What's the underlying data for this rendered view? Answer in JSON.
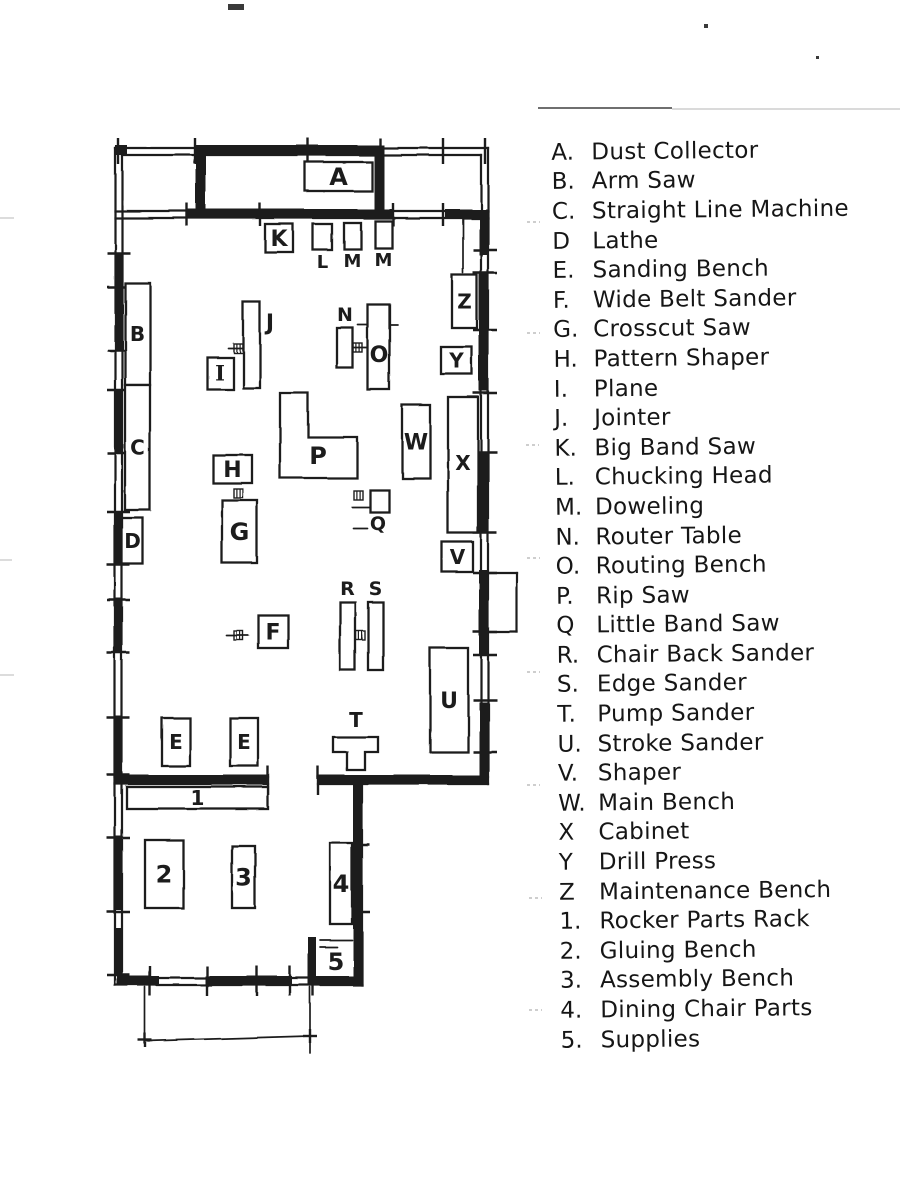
{
  "document_title": "Woodshop floor plan sketch with machine legend",
  "ink_color": "#1c1c1c",
  "paper_color": "#ffffff",
  "legend": {
    "items": [
      {
        "key": "A.",
        "label": "Dust Collector"
      },
      {
        "key": "B.",
        "label": "Arm Saw"
      },
      {
        "key": "C.",
        "label": "Straight Line Machine"
      },
      {
        "key": "D",
        "label": "Lathe"
      },
      {
        "key": "E.",
        "label": "Sanding Bench"
      },
      {
        "key": "F.",
        "label": "Wide Belt Sander"
      },
      {
        "key": "G.",
        "label": "Crosscut Saw"
      },
      {
        "key": "H.",
        "label": "Pattern Shaper"
      },
      {
        "key": "I.",
        "label": "Plane"
      },
      {
        "key": "J.",
        "label": "Jointer"
      },
      {
        "key": "K.",
        "label": "Big Band Saw"
      },
      {
        "key": "L.",
        "label": "Chucking Head"
      },
      {
        "key": "M.",
        "label": "Doweling"
      },
      {
        "key": "N.",
        "label": "Router Table"
      },
      {
        "key": "O.",
        "label": "Routing Bench"
      },
      {
        "key": "P.",
        "label": "Rip Saw"
      },
      {
        "key": "Q",
        "label": "Little Band Saw"
      },
      {
        "key": "R.",
        "label": "Chair Back Sander"
      },
      {
        "key": "S.",
        "label": "Edge Sander"
      },
      {
        "key": "T.",
        "label": "Pump Sander"
      },
      {
        "key": "U.",
        "label": "Stroke Sander"
      },
      {
        "key": "V.",
        "label": "Shaper"
      },
      {
        "key": "W.",
        "label": "Main Bench"
      },
      {
        "key": "X",
        "label": "Cabinet"
      },
      {
        "key": "Y",
        "label": "Drill Press"
      },
      {
        "key": "Z",
        "label": "Maintenance Bench"
      },
      {
        "key": "1.",
        "label": "Rocker Parts Rack"
      },
      {
        "key": "2.",
        "label": "Gluing Bench"
      },
      {
        "key": "3.",
        "label": "Assembly Bench"
      },
      {
        "key": "4.",
        "label": "Dining Chair Parts"
      },
      {
        "key": "5.",
        "label": "Supplies"
      }
    ]
  },
  "floorplan": {
    "machines": [
      {
        "id": "A",
        "label": "A",
        "x": 305,
        "y": 162,
        "w": 67,
        "h": 29,
        "pos": "inside",
        "size": 24
      },
      {
        "id": "K",
        "label": "K",
        "x": 265,
        "y": 224,
        "w": 28,
        "h": 28,
        "pos": "inside",
        "size": 22
      },
      {
        "id": "L",
        "label": "L",
        "x": 313,
        "y": 224,
        "w": 19,
        "h": 26,
        "pos": "below",
        "size": 18
      },
      {
        "id": "M1",
        "label": "M",
        "x": 344,
        "y": 223,
        "w": 17,
        "h": 26,
        "pos": "below",
        "size": 18
      },
      {
        "id": "M2",
        "label": "M",
        "x": 375,
        "y": 221,
        "w": 17,
        "h": 27,
        "pos": "below",
        "size": 18
      },
      {
        "id": "B",
        "label": "B",
        "x": 125,
        "y": 283,
        "w": 25,
        "h": 102,
        "pos": "inside",
        "size": 20
      },
      {
        "id": "C",
        "label": "C",
        "x": 125,
        "y": 385,
        "w": 25,
        "h": 125,
        "pos": "inside",
        "size": 20
      },
      {
        "id": "D",
        "label": "D",
        "x": 122,
        "y": 518,
        "w": 21,
        "h": 46,
        "pos": "inside",
        "size": 20
      },
      {
        "id": "I",
        "label": "I",
        "x": 207,
        "y": 357,
        "w": 26,
        "h": 32,
        "pos": "inside",
        "size": 21,
        "serif": true
      },
      {
        "id": "J",
        "label": "J",
        "x": 243,
        "y": 302,
        "w": 17,
        "h": 86,
        "pos": "right",
        "size": 22,
        "lx": 270,
        "ly": 330
      },
      {
        "id": "N",
        "label": "N",
        "x": 337,
        "y": 328,
        "w": 16,
        "h": 40,
        "pos": "above",
        "size": 19
      },
      {
        "id": "O",
        "label": "O",
        "x": 368,
        "y": 305,
        "w": 22,
        "h": 85,
        "pos": "inside",
        "size": 22,
        "ly": 362
      },
      {
        "id": "Z",
        "label": "Z",
        "x": 452,
        "y": 275,
        "w": 25,
        "h": 53,
        "pos": "inside",
        "size": 20
      },
      {
        "id": "Y",
        "label": "Y",
        "x": 441,
        "y": 347,
        "w": 31,
        "h": 27,
        "pos": "inside",
        "size": 20
      },
      {
        "id": "H",
        "label": "H",
        "x": 213,
        "y": 455,
        "w": 39,
        "h": 28,
        "pos": "inside",
        "size": 22
      },
      {
        "id": "G",
        "label": "G",
        "x": 222,
        "y": 500,
        "w": 35,
        "h": 63,
        "pos": "inside",
        "size": 24
      },
      {
        "id": "W",
        "label": "W",
        "x": 402,
        "y": 405,
        "w": 28,
        "h": 73,
        "pos": "inside",
        "size": 22
      },
      {
        "id": "X",
        "label": "X",
        "x": 448,
        "y": 397,
        "w": 30,
        "h": 136,
        "pos": "inside",
        "size": 20,
        "ly": 470
      },
      {
        "id": "Q",
        "label": "Q",
        "x": 370,
        "y": 490,
        "w": 19,
        "h": 22,
        "pos": "below",
        "size": 19,
        "lx": 378,
        "ly": 530
      },
      {
        "id": "V",
        "label": "V",
        "x": 442,
        "y": 542,
        "w": 31,
        "h": 30,
        "pos": "inside",
        "size": 20
      },
      {
        "id": "F",
        "label": "F",
        "x": 258,
        "y": 615,
        "w": 30,
        "h": 33,
        "pos": "inside",
        "size": 22
      },
      {
        "id": "R",
        "label": "R",
        "x": 340,
        "y": 602,
        "w": 15,
        "h": 68,
        "pos": "above",
        "size": 19
      },
      {
        "id": "S",
        "label": "S",
        "x": 368,
        "y": 602,
        "w": 15,
        "h": 68,
        "pos": "above",
        "size": 19
      },
      {
        "id": "U",
        "label": "U",
        "x": 430,
        "y": 648,
        "w": 38,
        "h": 104,
        "pos": "inside",
        "size": 22
      },
      {
        "id": "E1",
        "label": "E",
        "x": 162,
        "y": 718,
        "w": 28,
        "h": 48,
        "pos": "inside",
        "size": 20
      },
      {
        "id": "E2",
        "label": "E",
        "x": 230,
        "y": 718,
        "w": 28,
        "h": 48,
        "pos": "inside",
        "size": 20
      },
      {
        "id": "rack-1",
        "label": "1",
        "x": 127,
        "y": 787,
        "w": 141,
        "h": 22,
        "pos": "inside",
        "size": 20,
        "ly": 805
      },
      {
        "id": "bench-2",
        "label": "2",
        "x": 145,
        "y": 840,
        "w": 38,
        "h": 68,
        "pos": "inside",
        "size": 24
      },
      {
        "id": "bench-3",
        "label": "3",
        "x": 232,
        "y": 846,
        "w": 23,
        "h": 62,
        "pos": "inside",
        "size": 24
      },
      {
        "id": "parts-4",
        "label": "4",
        "x": 330,
        "y": 843,
        "w": 22,
        "h": 81,
        "pos": "inside",
        "size": 24
      }
    ],
    "polygons": [
      {
        "id": "P",
        "label": "P",
        "points": "280,393 308,393 308,437 357,437 357,478 280,478",
        "lx": 318,
        "ly": 464,
        "size": 24
      },
      {
        "id": "T",
        "label": "T",
        "points": "333,737 378,737 378,752 365,752 365,770 347,770 347,752 333,752",
        "lx": 356,
        "ly": 727,
        "size": 20
      }
    ],
    "texts": [
      {
        "label": "5",
        "x": 336,
        "y": 970,
        "size": 24
      }
    ],
    "wall_lines": [
      [
        115,
        148,
        488,
        148
      ],
      [
        122,
        155,
        481,
        155
      ],
      [
        115,
        148,
        115,
        985
      ],
      [
        122,
        155,
        122,
        978
      ],
      [
        488,
        148,
        488,
        784
      ],
      [
        481,
        155,
        481,
        777
      ],
      [
        115,
        211,
        488,
        211
      ],
      [
        115,
        218,
        488,
        218
      ],
      [
        318,
        777,
        488,
        777
      ],
      [
        318,
        784,
        488,
        784
      ],
      [
        355,
        784,
        355,
        978
      ],
      [
        362,
        777,
        362,
        985
      ],
      [
        115,
        985,
        362,
        985
      ],
      [
        122,
        978,
        355,
        978
      ],
      [
        115,
        777,
        268,
        777
      ],
      [
        115,
        784,
        268,
        784
      ],
      [
        488,
        573,
        517,
        573
      ],
      [
        517,
        573,
        517,
        632
      ],
      [
        488,
        632,
        517,
        632
      ]
    ],
    "wall_fills": [
      [
        114,
        253,
        9,
        97
      ],
      [
        114,
        390,
        9,
        63
      ],
      [
        114,
        512,
        9,
        53
      ],
      [
        114,
        598,
        9,
        55
      ],
      [
        114,
        716,
        9,
        59
      ],
      [
        114,
        836,
        9,
        74
      ],
      [
        114,
        928,
        9,
        47
      ],
      [
        196,
        145,
        188,
        10
      ],
      [
        115,
        145,
        12,
        10
      ],
      [
        479,
        215,
        9,
        40
      ],
      [
        479,
        273,
        9,
        118
      ],
      [
        479,
        452,
        9,
        81
      ],
      [
        479,
        570,
        9,
        85
      ],
      [
        479,
        702,
        9,
        78
      ],
      [
        188,
        209,
        205,
        10
      ],
      [
        445,
        209,
        43,
        10
      ],
      [
        115,
        775,
        153,
        10
      ],
      [
        318,
        775,
        170,
        10
      ],
      [
        353,
        779,
        9,
        206
      ],
      [
        117,
        976,
        42,
        10
      ],
      [
        205,
        976,
        87,
        10
      ],
      [
        308,
        976,
        54,
        10
      ],
      [
        308,
        937,
        8,
        48
      ],
      [
        196,
        148,
        10,
        71
      ],
      [
        374,
        148,
        10,
        71
      ]
    ],
    "ticks": [
      [
        107,
        253,
        130,
        253
      ],
      [
        107,
        287,
        130,
        287
      ],
      [
        107,
        350,
        130,
        350
      ],
      [
        107,
        390,
        130,
        390
      ],
      [
        107,
        453,
        130,
        453
      ],
      [
        107,
        512,
        130,
        512
      ],
      [
        107,
        565,
        130,
        565
      ],
      [
        107,
        600,
        130,
        600
      ],
      [
        107,
        653,
        130,
        653
      ],
      [
        107,
        718,
        130,
        718
      ],
      [
        107,
        775,
        130,
        775
      ],
      [
        107,
        838,
        130,
        838
      ],
      [
        107,
        912,
        130,
        912
      ],
      [
        107,
        975,
        130,
        975
      ],
      [
        473,
        250,
        497,
        250
      ],
      [
        473,
        273,
        497,
        273
      ],
      [
        473,
        330,
        497,
        330
      ],
      [
        473,
        393,
        497,
        393
      ],
      [
        473,
        452,
        497,
        452
      ],
      [
        473,
        533,
        497,
        533
      ],
      [
        473,
        573,
        497,
        573
      ],
      [
        473,
        632,
        497,
        632
      ],
      [
        473,
        655,
        497,
        655
      ],
      [
        473,
        700,
        497,
        700
      ],
      [
        473,
        752,
        497,
        752
      ],
      [
        118,
        138,
        118,
        164
      ],
      [
        195,
        138,
        195,
        164
      ],
      [
        308,
        138,
        308,
        164
      ],
      [
        380,
        138,
        380,
        164
      ],
      [
        443,
        138,
        443,
        164
      ],
      [
        485,
        138,
        485,
        164
      ],
      [
        187,
        203,
        187,
        226
      ],
      [
        260,
        203,
        260,
        226
      ],
      [
        393,
        203,
        393,
        226
      ],
      [
        443,
        203,
        443,
        226
      ],
      [
        150,
        966,
        150,
        996
      ],
      [
        207,
        966,
        207,
        996
      ],
      [
        257,
        966,
        257,
        996
      ],
      [
        290,
        966,
        290,
        996
      ],
      [
        313,
        966,
        313,
        996
      ],
      [
        268,
        766,
        268,
        795
      ],
      [
        318,
        766,
        318,
        795
      ],
      [
        346,
        845,
        370,
        845
      ],
      [
        346,
        912,
        370,
        912
      ],
      [
        138,
        1040,
        152,
        1040
      ],
      [
        145,
        1033,
        145,
        1047
      ],
      [
        303,
        1036,
        317,
        1036
      ],
      [
        310,
        1029,
        310,
        1043
      ]
    ],
    "thin_lines": [
      [
        463,
        219,
        463,
        273
      ],
      [
        358,
        325,
        398,
        325
      ],
      [
        228,
        348,
        247,
        348
      ],
      [
        349,
        348,
        367,
        348
      ],
      [
        352,
        507,
        371,
        507
      ],
      [
        353,
        528,
        367,
        528
      ],
      [
        226,
        635,
        248,
        635
      ],
      [
        320,
        940,
        352,
        940
      ],
      [
        320,
        947,
        337,
        947
      ],
      [
        145,
        987,
        145,
        1038
      ],
      [
        310,
        987,
        310,
        1053
      ],
      [
        145,
        1041,
        310,
        1036
      ]
    ],
    "hatches": [
      [
        238,
        348
      ],
      [
        358,
        348
      ],
      [
        238,
        493
      ],
      [
        358,
        495
      ],
      [
        238,
        635
      ],
      [
        360,
        635
      ]
    ]
  },
  "page_marks": {
    "dark_lines": [
      [
        538,
        108,
        672,
        108
      ]
    ],
    "faint_lines": [
      [
        672,
        109,
        905,
        109
      ],
      [
        0,
        218,
        14,
        218
      ],
      [
        0,
        560,
        12,
        560
      ],
      [
        0,
        675,
        14,
        675
      ]
    ],
    "margin_dashes": [
      [
        527,
        222
      ],
      [
        527,
        333
      ],
      [
        526,
        445
      ],
      [
        527,
        558
      ],
      [
        527,
        672
      ],
      [
        527,
        785
      ],
      [
        529,
        898
      ],
      [
        529,
        1010
      ]
    ],
    "specks": [
      [
        228,
        4,
        16,
        6
      ],
      [
        704,
        24,
        4,
        4
      ],
      [
        816,
        56,
        3,
        3
      ]
    ]
  }
}
